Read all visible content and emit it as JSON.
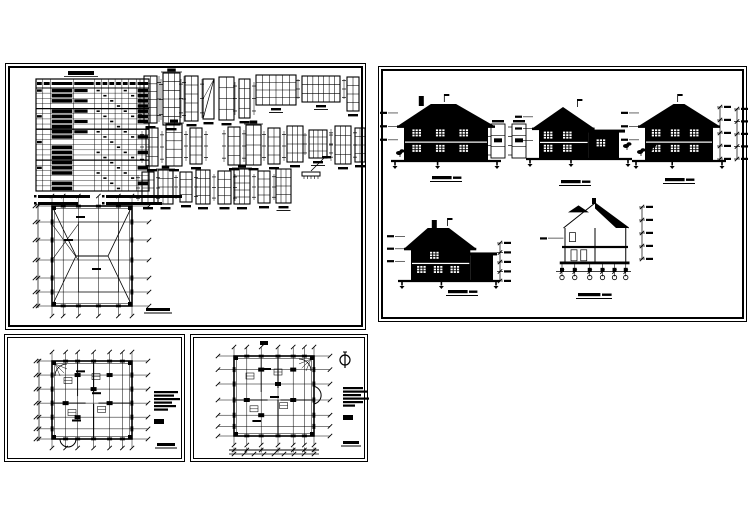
{
  "meta": {
    "width": 749,
    "height": 530,
    "bg": "#ffffff",
    "ink": "#000000"
  },
  "panels": [
    {
      "name": "sheet-window-door-schedule-and-roof-plan",
      "x": 5,
      "y": 63,
      "w": 361,
      "h": 267,
      "schedule": {
        "name": "door-window-schedule-table",
        "x": 30,
        "y": 15,
        "w": 113,
        "h": 112,
        "rows": 20,
        "header_h": 9,
        "cols": [
          0,
          0.06,
          0.13,
          0.33,
          0.52,
          0.58,
          0.64,
          0.7,
          0.76,
          0.82,
          0.89,
          1
        ],
        "title": {
          "x": 62,
          "y": 7,
          "w": 26,
          "h": 4
        },
        "notes": [
          [
            28,
            131,
            52,
            3
          ],
          [
            96,
            131,
            76,
            3
          ],
          [
            28,
            138,
            40,
            3
          ],
          [
            96,
            138,
            56,
            3
          ]
        ]
      },
      "window_figures": [
        {
          "x": 138,
          "y": 12,
          "w": 13,
          "h": 47,
          "c": 2,
          "r": 6,
          "fl": 1
        },
        {
          "x": 157,
          "y": 9,
          "w": 17,
          "h": 52,
          "c": 3,
          "r": 6,
          "fl": 1,
          "ct": 1
        },
        {
          "x": 179,
          "y": 12,
          "w": 13,
          "h": 45,
          "c": 2,
          "r": 5,
          "fl": 1
        },
        {
          "x": 197,
          "y": 15,
          "w": 11,
          "h": 40,
          "dg": 1
        },
        {
          "x": 213,
          "y": 13,
          "w": 15,
          "h": 43,
          "c": 2,
          "r": 4
        },
        {
          "x": 233,
          "y": 15,
          "w": 11,
          "h": 39,
          "c": 2,
          "r": 4,
          "fl": 1
        },
        {
          "x": 250,
          "y": 11,
          "w": 40,
          "h": 30,
          "c": 6,
          "r": 4,
          "cap": 1
        },
        {
          "x": 296,
          "y": 12,
          "w": 38,
          "h": 26,
          "c": 7,
          "r": 3,
          "cap": 1,
          "fl": 1
        },
        {
          "x": 341,
          "y": 13,
          "w": 12,
          "h": 34,
          "c": 2,
          "r": 4
        },
        {
          "x": 140,
          "y": 64,
          "w": 12,
          "h": 38,
          "c": 2,
          "r": 4,
          "fl": 1
        },
        {
          "x": 160,
          "y": 60,
          "w": 16,
          "h": 42,
          "c": 2,
          "r": 5,
          "ct": 1
        },
        {
          "x": 184,
          "y": 64,
          "w": 12,
          "h": 36,
          "c": 2,
          "r": 4,
          "fl": 1
        },
        {
          "x": 222,
          "y": 63,
          "w": 12,
          "h": 38,
          "c": 2,
          "r": 4,
          "fl": 1
        },
        {
          "x": 240,
          "y": 61,
          "w": 15,
          "h": 40,
          "c": 2,
          "r": 4,
          "ct": 1
        },
        {
          "x": 262,
          "y": 64,
          "w": 12,
          "h": 36,
          "c": 2,
          "r": 4,
          "fl": 1
        },
        {
          "x": 281,
          "y": 62,
          "w": 16,
          "h": 36,
          "c": 3,
          "r": 4
        },
        {
          "x": 303,
          "y": 66,
          "w": 18,
          "h": 28,
          "c": 4,
          "r": 4,
          "cap": 1,
          "fl": 1
        },
        {
          "x": 329,
          "y": 62,
          "w": 16,
          "h": 38,
          "c": 3,
          "r": 4,
          "fl": 1
        },
        {
          "x": 349,
          "y": 64,
          "w": 10,
          "h": 34,
          "c": 2,
          "r": 4
        },
        {
          "x": 136,
          "y": 108,
          "w": 12,
          "h": 32,
          "c": 2,
          "r": 4,
          "fl": 1
        },
        {
          "x": 152,
          "y": 106,
          "w": 15,
          "h": 34,
          "c": 3,
          "r": 4,
          "ct": 1
        },
        {
          "x": 174,
          "y": 108,
          "w": 12,
          "h": 30,
          "c": 2,
          "r": 4,
          "fl": 1
        },
        {
          "x": 190,
          "y": 106,
          "w": 14,
          "h": 34,
          "c": 3,
          "r": 4
        },
        {
          "x": 212,
          "y": 107,
          "w": 13,
          "h": 33,
          "c": 2,
          "r": 4,
          "fl": 1
        },
        {
          "x": 228,
          "y": 105,
          "w": 16,
          "h": 35,
          "c": 3,
          "r": 5,
          "ct": 1
        },
        {
          "x": 252,
          "y": 107,
          "w": 12,
          "h": 32,
          "c": 2,
          "r": 4,
          "fl": 1
        },
        {
          "x": 270,
          "y": 105,
          "w": 15,
          "h": 34,
          "c": 3,
          "r": 4,
          "cap": 1
        }
      ],
      "special_detail": {
        "x": 296,
        "y": 94,
        "w": 22,
        "h": 24
      },
      "roof_plan": {
        "name": "roof-plan",
        "bx": 46,
        "by": 142,
        "bw": 80,
        "bh": 100,
        "vx": [
          0,
          0.14,
          0.33,
          0.58,
          0.83,
          1
        ],
        "vy": [
          0,
          0.16,
          0.34,
          0.54,
          0.72,
          0.86,
          1
        ],
        "ext": 10,
        "type": "roof",
        "left_dims": true,
        "labels": [
          [
            0.35,
            0.1
          ],
          [
            0.2,
            0.33
          ],
          [
            0.55,
            0.62
          ]
        ],
        "caption": {
          "cx": 152,
          "y": 244,
          "w": 24
        }
      }
    },
    {
      "name": "sheet-elevations-and-section",
      "x": 378,
      "y": 66,
      "w": 369,
      "h": 256,
      "elevations": [
        {
          "name": "elevation-1",
          "x": 25,
          "y": 37,
          "w": 84,
          "h": 56,
          "roof": "hip",
          "ch": 0.2,
          "caption": {
            "cx": 67,
            "y": 109
          }
        },
        {
          "name": "elevation-2",
          "x": 160,
          "y": 42,
          "w": 80,
          "h": 49,
          "roof": "gable-wing",
          "caption": {
            "cx": 196,
            "y": 113
          }
        },
        {
          "name": "elevation-3",
          "x": 266,
          "y": 37,
          "w": 68,
          "h": 56,
          "roof": "hip2",
          "caption": {
            "cx": 300,
            "y": 111
          }
        },
        {
          "name": "elevation-4",
          "x": 32,
          "y": 161,
          "w": 76,
          "h": 52,
          "roof": "hip-l",
          "ch": 0.3,
          "caption": {
            "cx": 83,
            "y": 223
          }
        }
      ],
      "detail_columns": [
        {
          "x": 112,
          "y": 57,
          "w": 14,
          "h": 34
        },
        {
          "x": 133,
          "y": 57,
          "w": 14,
          "h": 34
        }
      ],
      "dim_columns": [
        {
          "x": 341,
          "y": 40,
          "h": 52
        },
        {
          "x": 358,
          "y": 42,
          "h": 50
        },
        {
          "x": 121,
          "y": 176,
          "h": 38
        },
        {
          "x": 263,
          "y": 140,
          "h": 52
        }
      ],
      "foliage": [
        [
          20,
          86
        ],
        [
          247,
          79
        ],
        [
          261,
          85
        ],
        [
          272,
          80
        ]
      ],
      "section": {
        "name": "cross-section",
        "x": 177,
        "y": 136,
        "w": 75,
        "h": 78,
        "caption": {
          "cx": 215,
          "y": 226
        }
      }
    },
    {
      "name": "sheet-floor-plan-upper",
      "x": 4,
      "y": 334,
      "w": 181,
      "h": 128,
      "plan": {
        "name": "floor-plan-drawing",
        "bx": 47,
        "by": 26,
        "bw": 80,
        "bh": 78,
        "vx": [
          0,
          0.17,
          0.32,
          0.52,
          0.72,
          0.88,
          1
        ],
        "vy": [
          0,
          0.18,
          0.36,
          0.54,
          0.72,
          0.87,
          1
        ],
        "ext": 9,
        "type": "floor",
        "stair": "tl",
        "bay": "bl",
        "left_dims": true,
        "labels": [
          [
            0.35,
            0.12
          ],
          [
            0.55,
            0.4
          ],
          [
            0.3,
            0.75
          ]
        ]
      },
      "notes_block": {
        "x": 149,
        "y": 56,
        "gap": 3.5,
        "lines": [
          24,
          20,
          26,
          18,
          22,
          14
        ]
      },
      "legend_mark": {
        "x": 149,
        "y": 84,
        "w": 10,
        "h": 5
      },
      "caption": {
        "cx": 161,
        "y": 108,
        "w": 18
      }
    },
    {
      "name": "sheet-floor-plan-ground",
      "x": 190,
      "y": 334,
      "w": 178,
      "h": 128,
      "plan": {
        "name": "floor-plan-drawing",
        "bx": 43,
        "by": 21,
        "bw": 80,
        "bh": 80,
        "vx": [
          0,
          0.16,
          0.34,
          0.55,
          0.74,
          0.88,
          1
        ],
        "vy": [
          0,
          0.17,
          0.35,
          0.55,
          0.74,
          0.88,
          1
        ],
        "ext": 9,
        "type": "floor",
        "stair": "tr",
        "bay": "r",
        "bottom_dims": true,
        "top_mark": true,
        "labels": [
          [
            0.4,
            0.15
          ],
          [
            0.5,
            0.5
          ],
          [
            0.28,
            0.8
          ]
        ]
      },
      "north_arrow": {
        "name": "north-arrow",
        "cx": 154,
        "cy": 25,
        "r": 5
      },
      "notes_block": {
        "x": 152,
        "y": 52,
        "gap": 3.5,
        "lines": [
          20,
          24,
          18,
          26,
          20,
          12
        ]
      },
      "legend_mark": {
        "x": 152,
        "y": 80,
        "w": 10,
        "h": 5
      },
      "caption": {
        "cx": 160,
        "y": 106,
        "w": 16
      }
    }
  ]
}
